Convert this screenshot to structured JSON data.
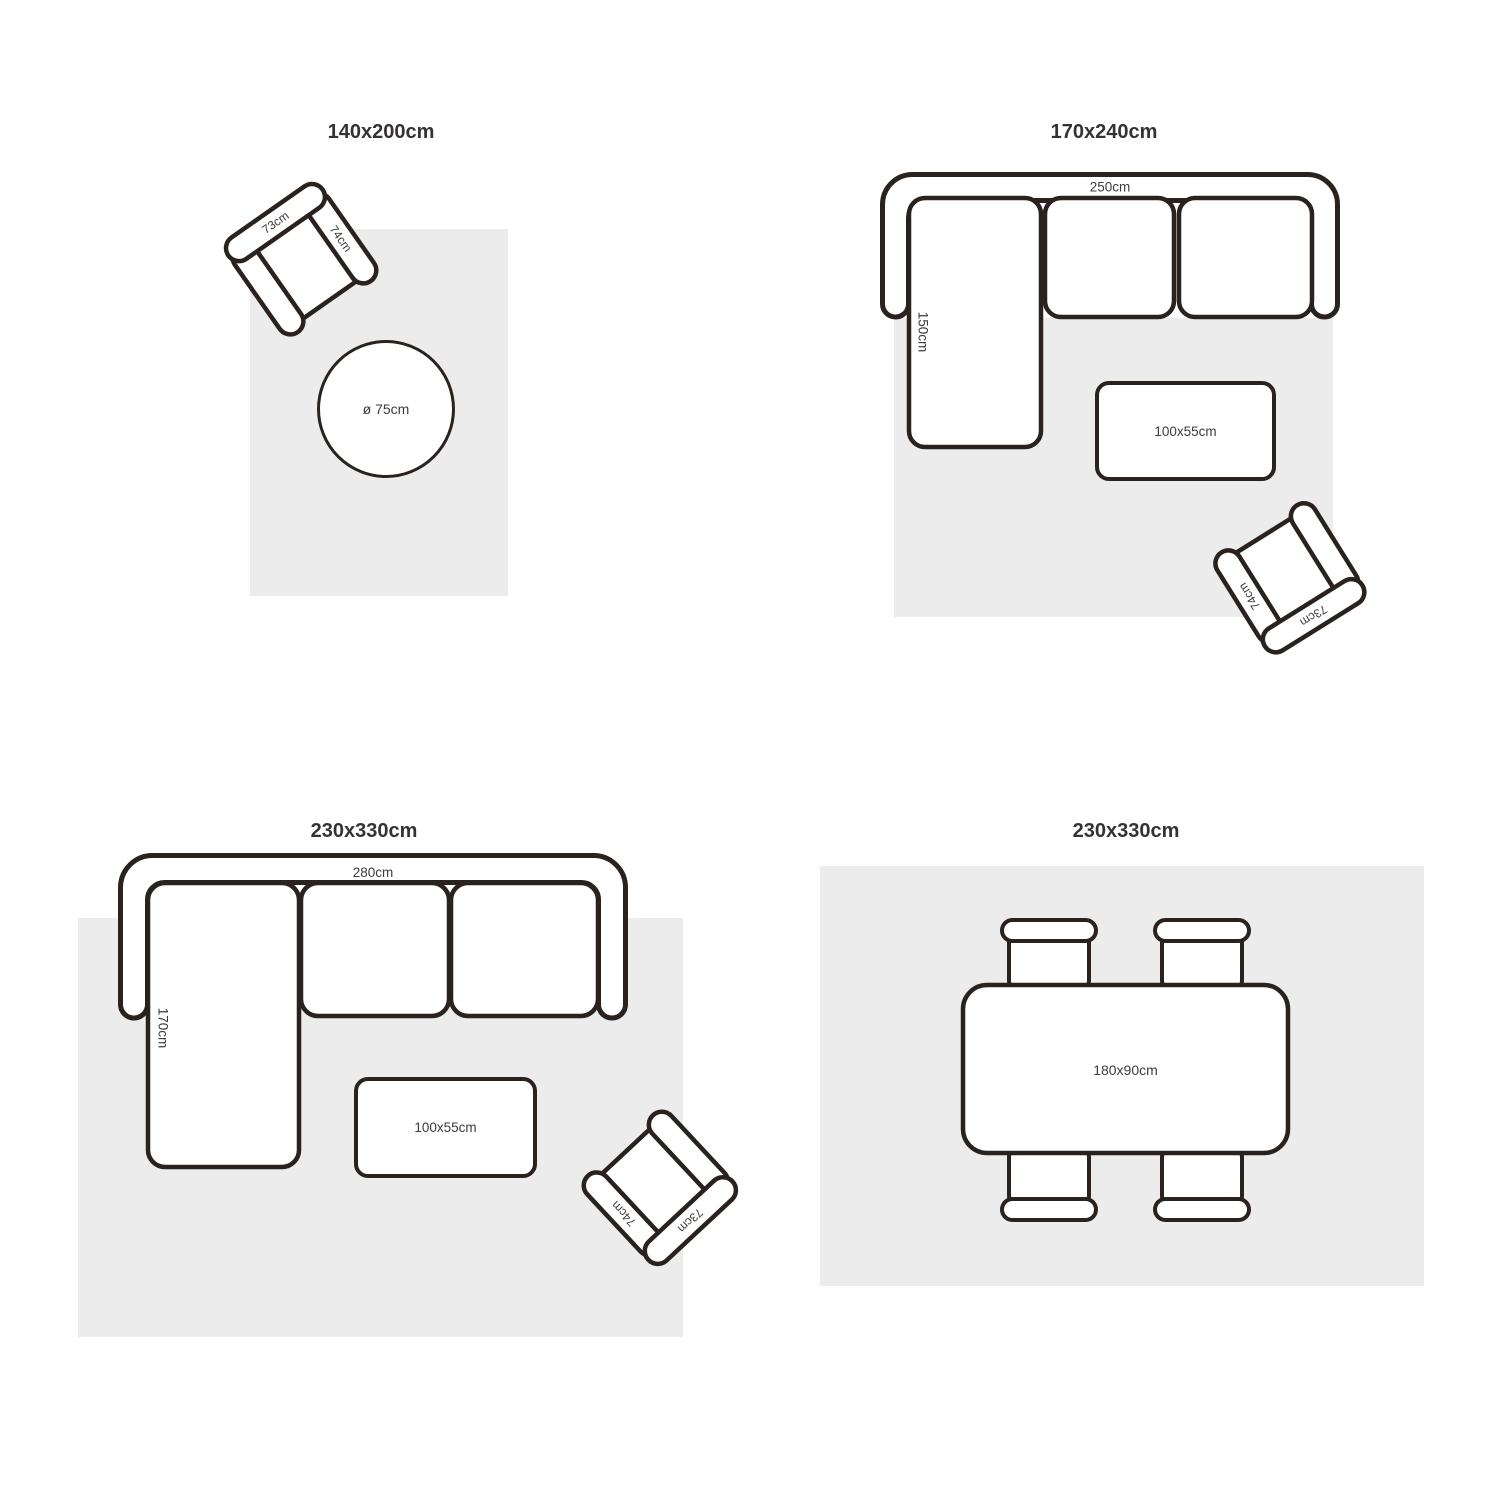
{
  "colors": {
    "rug": "#ececec",
    "stroke": "#29221f",
    "title": "#363233",
    "label": "#3e3a3a",
    "bg": "#ffffff"
  },
  "quadrants": {
    "q1": {
      "title": "140x200cm",
      "armchair": {
        "back": "73cm",
        "arm": "74cm"
      },
      "round_table": "ø 75cm"
    },
    "q2": {
      "title": "170x240cm",
      "sofa": {
        "width": "250cm",
        "chaise": "150cm"
      },
      "coffee_table": "100x55cm",
      "armchair": {
        "back": "73cm",
        "arm": "74cm"
      }
    },
    "q3": {
      "title": "230x330cm",
      "sofa": {
        "width": "280cm",
        "chaise": "170cm"
      },
      "coffee_table": "100x55cm",
      "armchair": {
        "back": "73cm",
        "arm": "74cm"
      }
    },
    "q4": {
      "title": "230x330cm",
      "dining_table": "180x90cm"
    }
  }
}
